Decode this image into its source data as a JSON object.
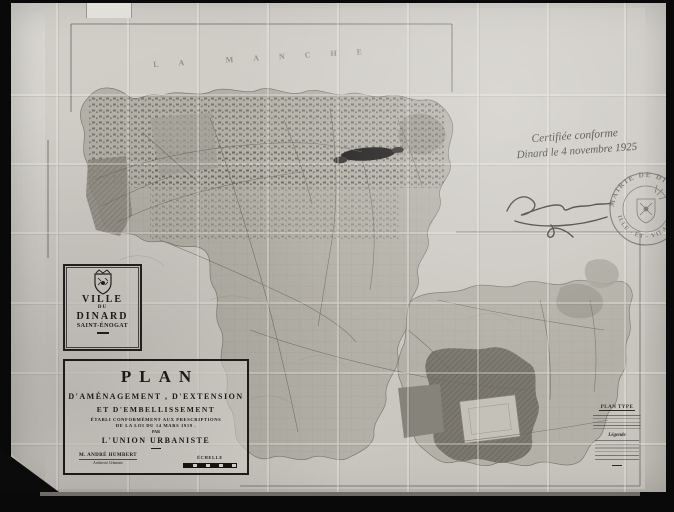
{
  "photo": {
    "description": "Photograph of a folded town-planning map"
  },
  "sea_label": {
    "text": "LA MANCHE"
  },
  "cartouche": {
    "line1": "VILLE",
    "line2": "DU",
    "line3": "DINARD",
    "line4": "SAINT-ÉNOGAT"
  },
  "title_block": {
    "title": "PLAN",
    "line1": "D'AMÉNAGEMENT , D'EXTENSION",
    "line2": "ET D'EMBELLISSEMENT",
    "line3": "ÉTABLI CONFORMÉMENT AUX PRESCRIPTIONS",
    "line4": "DE LA LOI DU 14 MARS 1919 .",
    "line5": "PAR",
    "line6": "L'UNION URBANISTE",
    "author_name": "M. ANDRÉ HUMBERT",
    "author_title": "Architecte Urbaniste",
    "scale_label": "ÉCHELLE"
  },
  "certification": {
    "line1": "Certifiée conforme",
    "line2": "Dinard le 4 novembre 1925"
  },
  "stamp": {
    "arc_top": "MAIRIE DE DINARD",
    "arc_bottom": "ILLE - ET - VILAINE"
  },
  "legend": {
    "heading": "PLAN TYPE",
    "legend_title": "Légende"
  },
  "colors": {
    "paper": "#d2cfc9",
    "map_tone": "#b3b0a7",
    "ink": "#1f1d19",
    "stamp_ink": "#55524b"
  }
}
